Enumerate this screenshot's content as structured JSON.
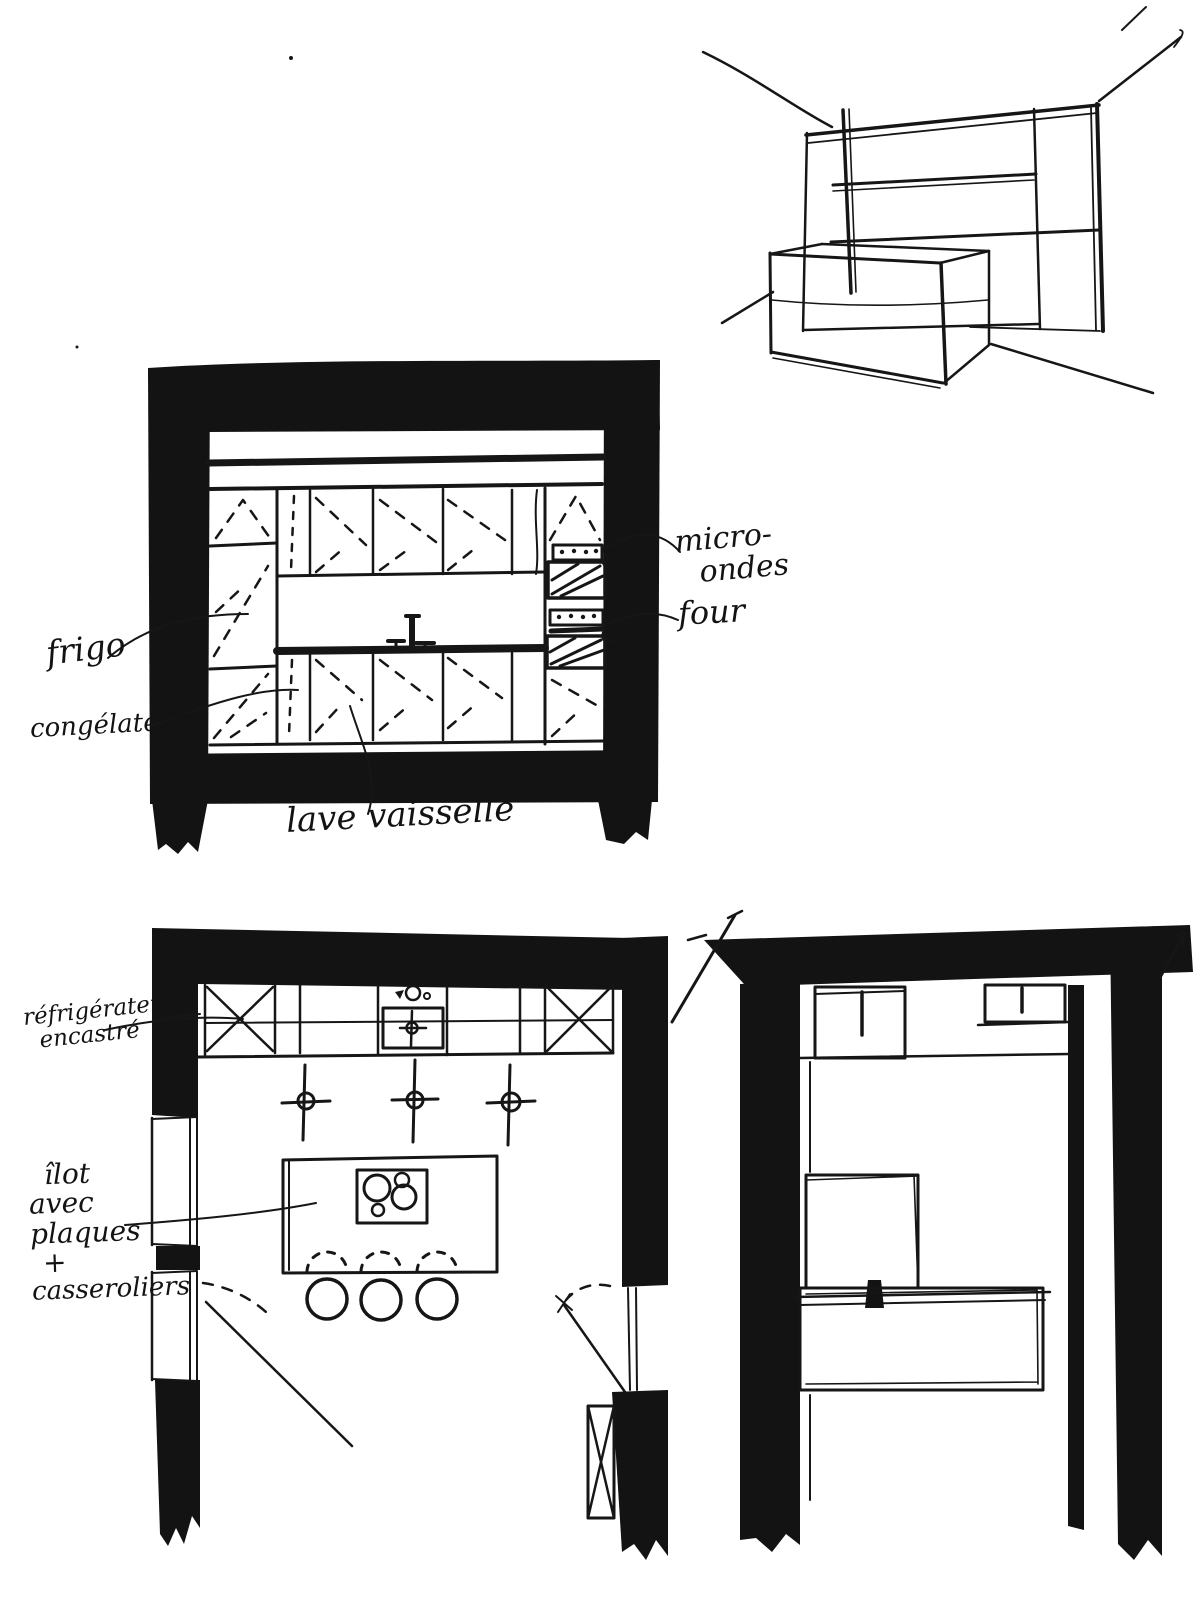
{
  "page": {
    "title": "Croquis cuisine - esquisses noir et blanc",
    "ink_color": "#161616",
    "paper_color": "#ffffff"
  },
  "annotations": {
    "micro_ondes": {
      "line1": "micro-",
      "line2": "ondes"
    },
    "four": "four",
    "frigo": "frigo",
    "congelateur": "congélateur",
    "lave_vaisselle": "lave vaisselle",
    "refrigerateur_encastre": {
      "line1": "réfrigérateur",
      "line2": "encastré"
    },
    "ilot": {
      "line1": "îlot",
      "line2": "avec",
      "line3": "plaques",
      "line4": "+",
      "line5": "casseroliers"
    }
  },
  "sketches": {
    "perspective": "vue perspective meuble / îlot",
    "elevation": "élévation cuisine",
    "plan_kitchen": "plan cuisine avec îlot",
    "plan_adjacent": "plan pièce adjacente"
  }
}
